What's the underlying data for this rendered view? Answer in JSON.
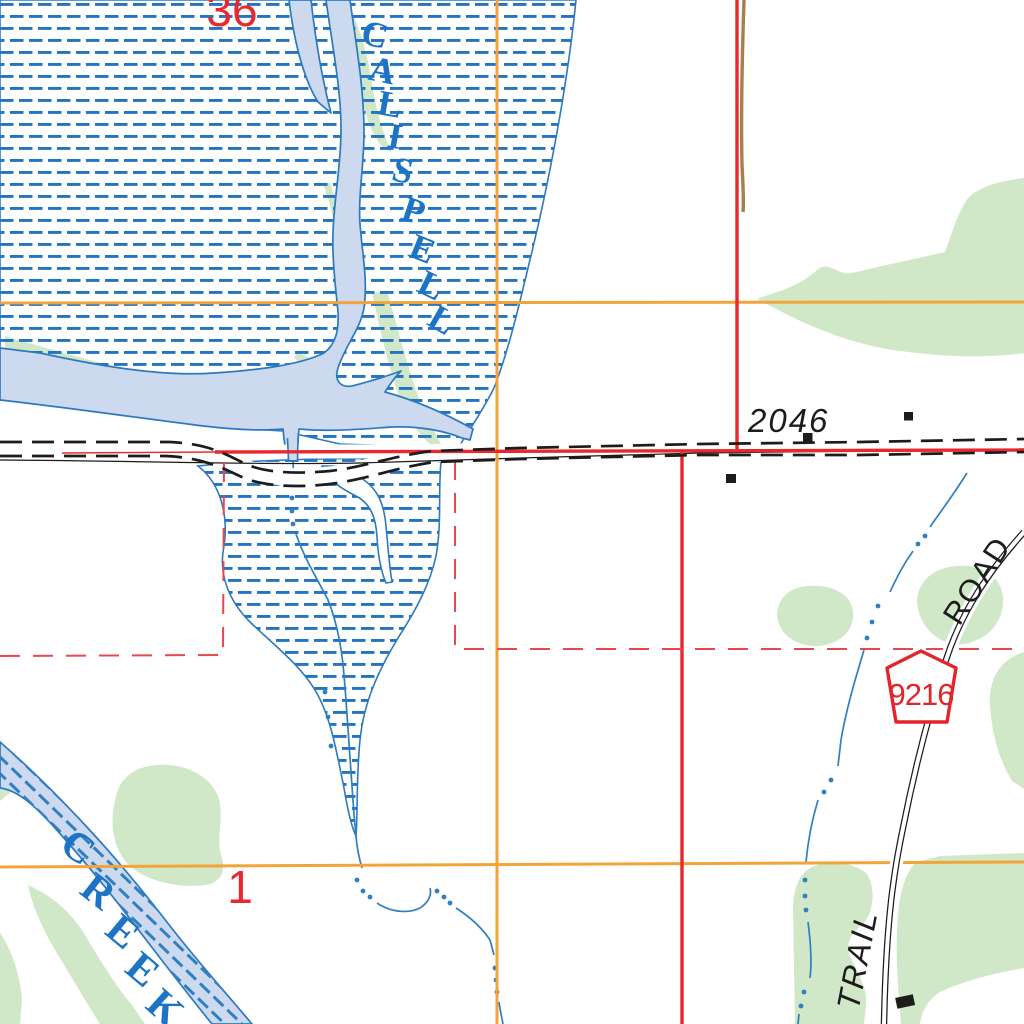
{
  "map": {
    "kind": "topographic-map-tile",
    "labels": {
      "calispell": {
        "letters": [
          "C",
          "A",
          "L",
          "I",
          "S",
          "P",
          "E",
          "L",
          "L"
        ],
        "word": "CALISPELL"
      },
      "creek": {
        "letters": [
          "C",
          "R",
          "E",
          "E",
          "K"
        ],
        "word": "CREEK"
      },
      "spot_elevation": "2046",
      "section_number_top": "36",
      "section_number_bottom": "1",
      "route_shield_number": "9216",
      "road_label": "ROAD",
      "trail_label": "TRAIL"
    },
    "colors": {
      "marsh_dash_blue": "#2474c2",
      "water_fill": "#cdd9ef",
      "water_outline": "#2b7ac0",
      "water_name_blue": "#1e74c4",
      "vegetation_green": "#d0e7c8",
      "grid_orange": "#f2a43b",
      "boundary_red": "#e8282e",
      "boundary_red_dashed": "#e8474d",
      "pipeline_brown": "#a87e4f",
      "road_black": "#1c1c1c"
    }
  }
}
